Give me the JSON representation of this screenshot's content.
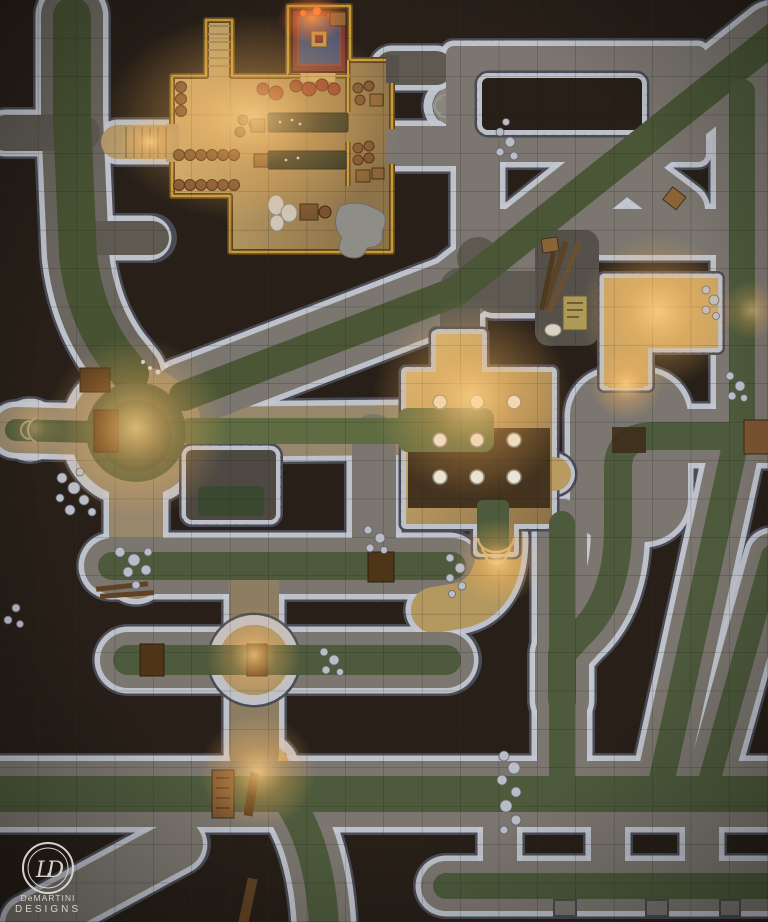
{
  "logo": {
    "monogram": "LD",
    "line1": "DeMARTINI",
    "line2": "DESIGNS"
  },
  "grid": {
    "columns": 20,
    "rows": 24,
    "cell_px": 38.4
  },
  "colors": {
    "bg": "#271f18",
    "grid_line": "#392c1f",
    "grid_dark": "#191310",
    "stone": "#7b766f",
    "stone_dark": "#5e5a52",
    "stone_warm": "#97876c",
    "wall_light": "#c3c7d1",
    "wall_dark": "#4b4b55",
    "water": "#4d5a3c",
    "water_dark": "#3b4830",
    "water_bright": "#5f6c42",
    "lit_floor": "#c6a365",
    "lit_bright": "#e7c27a",
    "wood_wall": "#c89a36",
    "wood_wall_dark": "#5a431e",
    "wood": "#7a5531",
    "wood_dark": "#4f3518",
    "table": "#2c3326",
    "barrel": "#7b5130",
    "crate": "#8a6437",
    "rug_red": "#7c3b32",
    "rug_blue": "#4e5674",
    "rug_gold": "#bd9752",
    "sack": "#cdc5b6",
    "pillar": "#e9e7df",
    "rubble": "#b9bdc8",
    "rubble_dark": "#62626e",
    "glow": "#ffc46a",
    "ember": "#ff7a33",
    "dim_room": "#55514a",
    "logo_ink": "#d6d3cf"
  },
  "features": [
    "warehouse-hall",
    "rug-chamber",
    "stair-landing",
    "left-canal",
    "central-hub",
    "hub-pool",
    "main-diagonal-channel",
    "loop-corridor",
    "pillared-chamber",
    "collapsed-storeroom",
    "lantern-room",
    "bulb-junction",
    "mid-sewer-channel",
    "round-chamber",
    "south-sewer-channel",
    "bottom-sewer-channel",
    "maker-logo"
  ]
}
